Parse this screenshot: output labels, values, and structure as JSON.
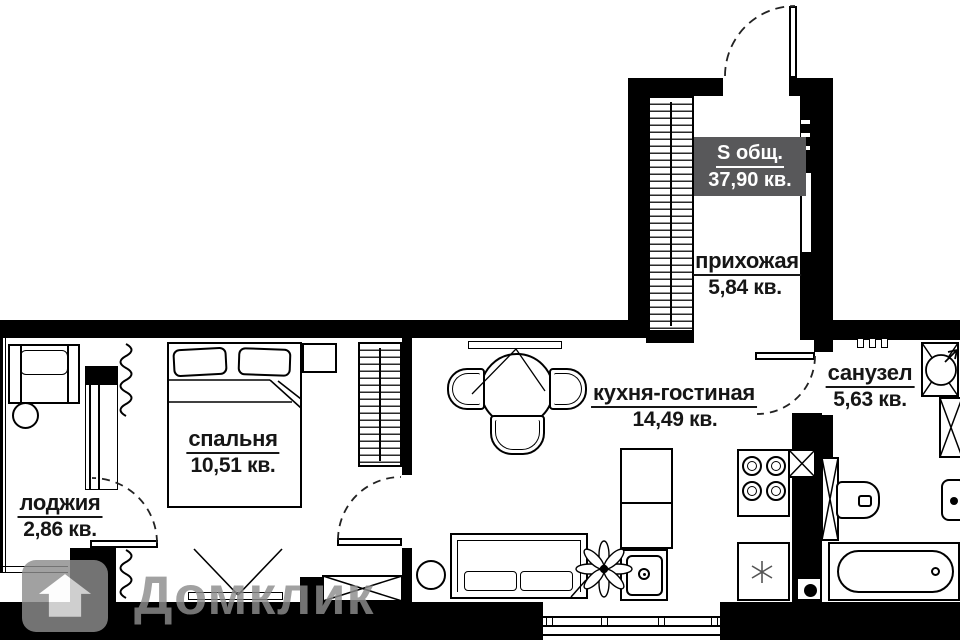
{
  "plan_title": "apartment-floor-plan",
  "badge": {
    "label": "S общ.",
    "value": "37,90 кв.",
    "bg_color": "#58585a",
    "text_color": "#ffffff"
  },
  "rooms": {
    "hallway": {
      "name": "прихожая",
      "area": "5,84 кв."
    },
    "kitchen_living": {
      "name": "кухня-гостиная",
      "area": "14,49 кв."
    },
    "bathroom": {
      "name": "санузел",
      "area": "5,63 кв."
    },
    "bedroom": {
      "name": "спальня",
      "area": "10,51 кв."
    },
    "loggia": {
      "name": "лоджия",
      "area": "2,86 кв."
    }
  },
  "watermark": {
    "brand": "Домклик",
    "color": "#8d8d8d"
  },
  "colors": {
    "walls": "#000000",
    "background": "#ffffff"
  }
}
